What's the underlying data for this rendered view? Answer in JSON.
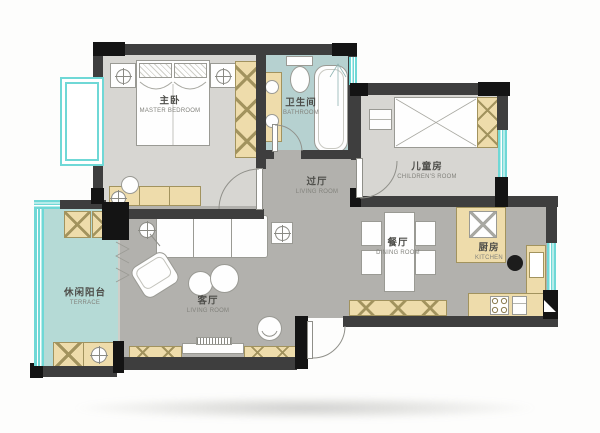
{
  "rooms": [
    {
      "id": "master-bedroom",
      "zh": "主卧",
      "en": "MASTER BEDROOM"
    },
    {
      "id": "bathroom",
      "zh": "卫生间",
      "en": "BATHROOM"
    },
    {
      "id": "children-room",
      "zh": "儿童房",
      "en": "CHILDREN'S ROOM"
    },
    {
      "id": "hallway",
      "zh": "过厅",
      "en": "LIVING ROOM"
    },
    {
      "id": "living-room",
      "zh": "客厅",
      "en": "LIVING ROOM"
    },
    {
      "id": "dining-room",
      "zh": "餐厅",
      "en": "DINING ROOM"
    },
    {
      "id": "kitchen",
      "zh": "厨房",
      "en": "KITCHEN"
    },
    {
      "id": "balcony",
      "zh": "休闲阳台",
      "en": "TERRACE"
    }
  ],
  "colors": {
    "wall": "#3e3e3e",
    "wall_dark": "#141414",
    "floor_bedroom": "#d7d6d2",
    "floor_main": "#b2b1ad",
    "floor_bath": "#b6d1d0",
    "floor_balcony": "#b5dad6",
    "window": "#6fd8d6",
    "furniture_tan": "#eedcab",
    "furniture_tan_line": "#a2935e",
    "furniture_white": "#fefefe",
    "outline": "#9a9a94"
  }
}
